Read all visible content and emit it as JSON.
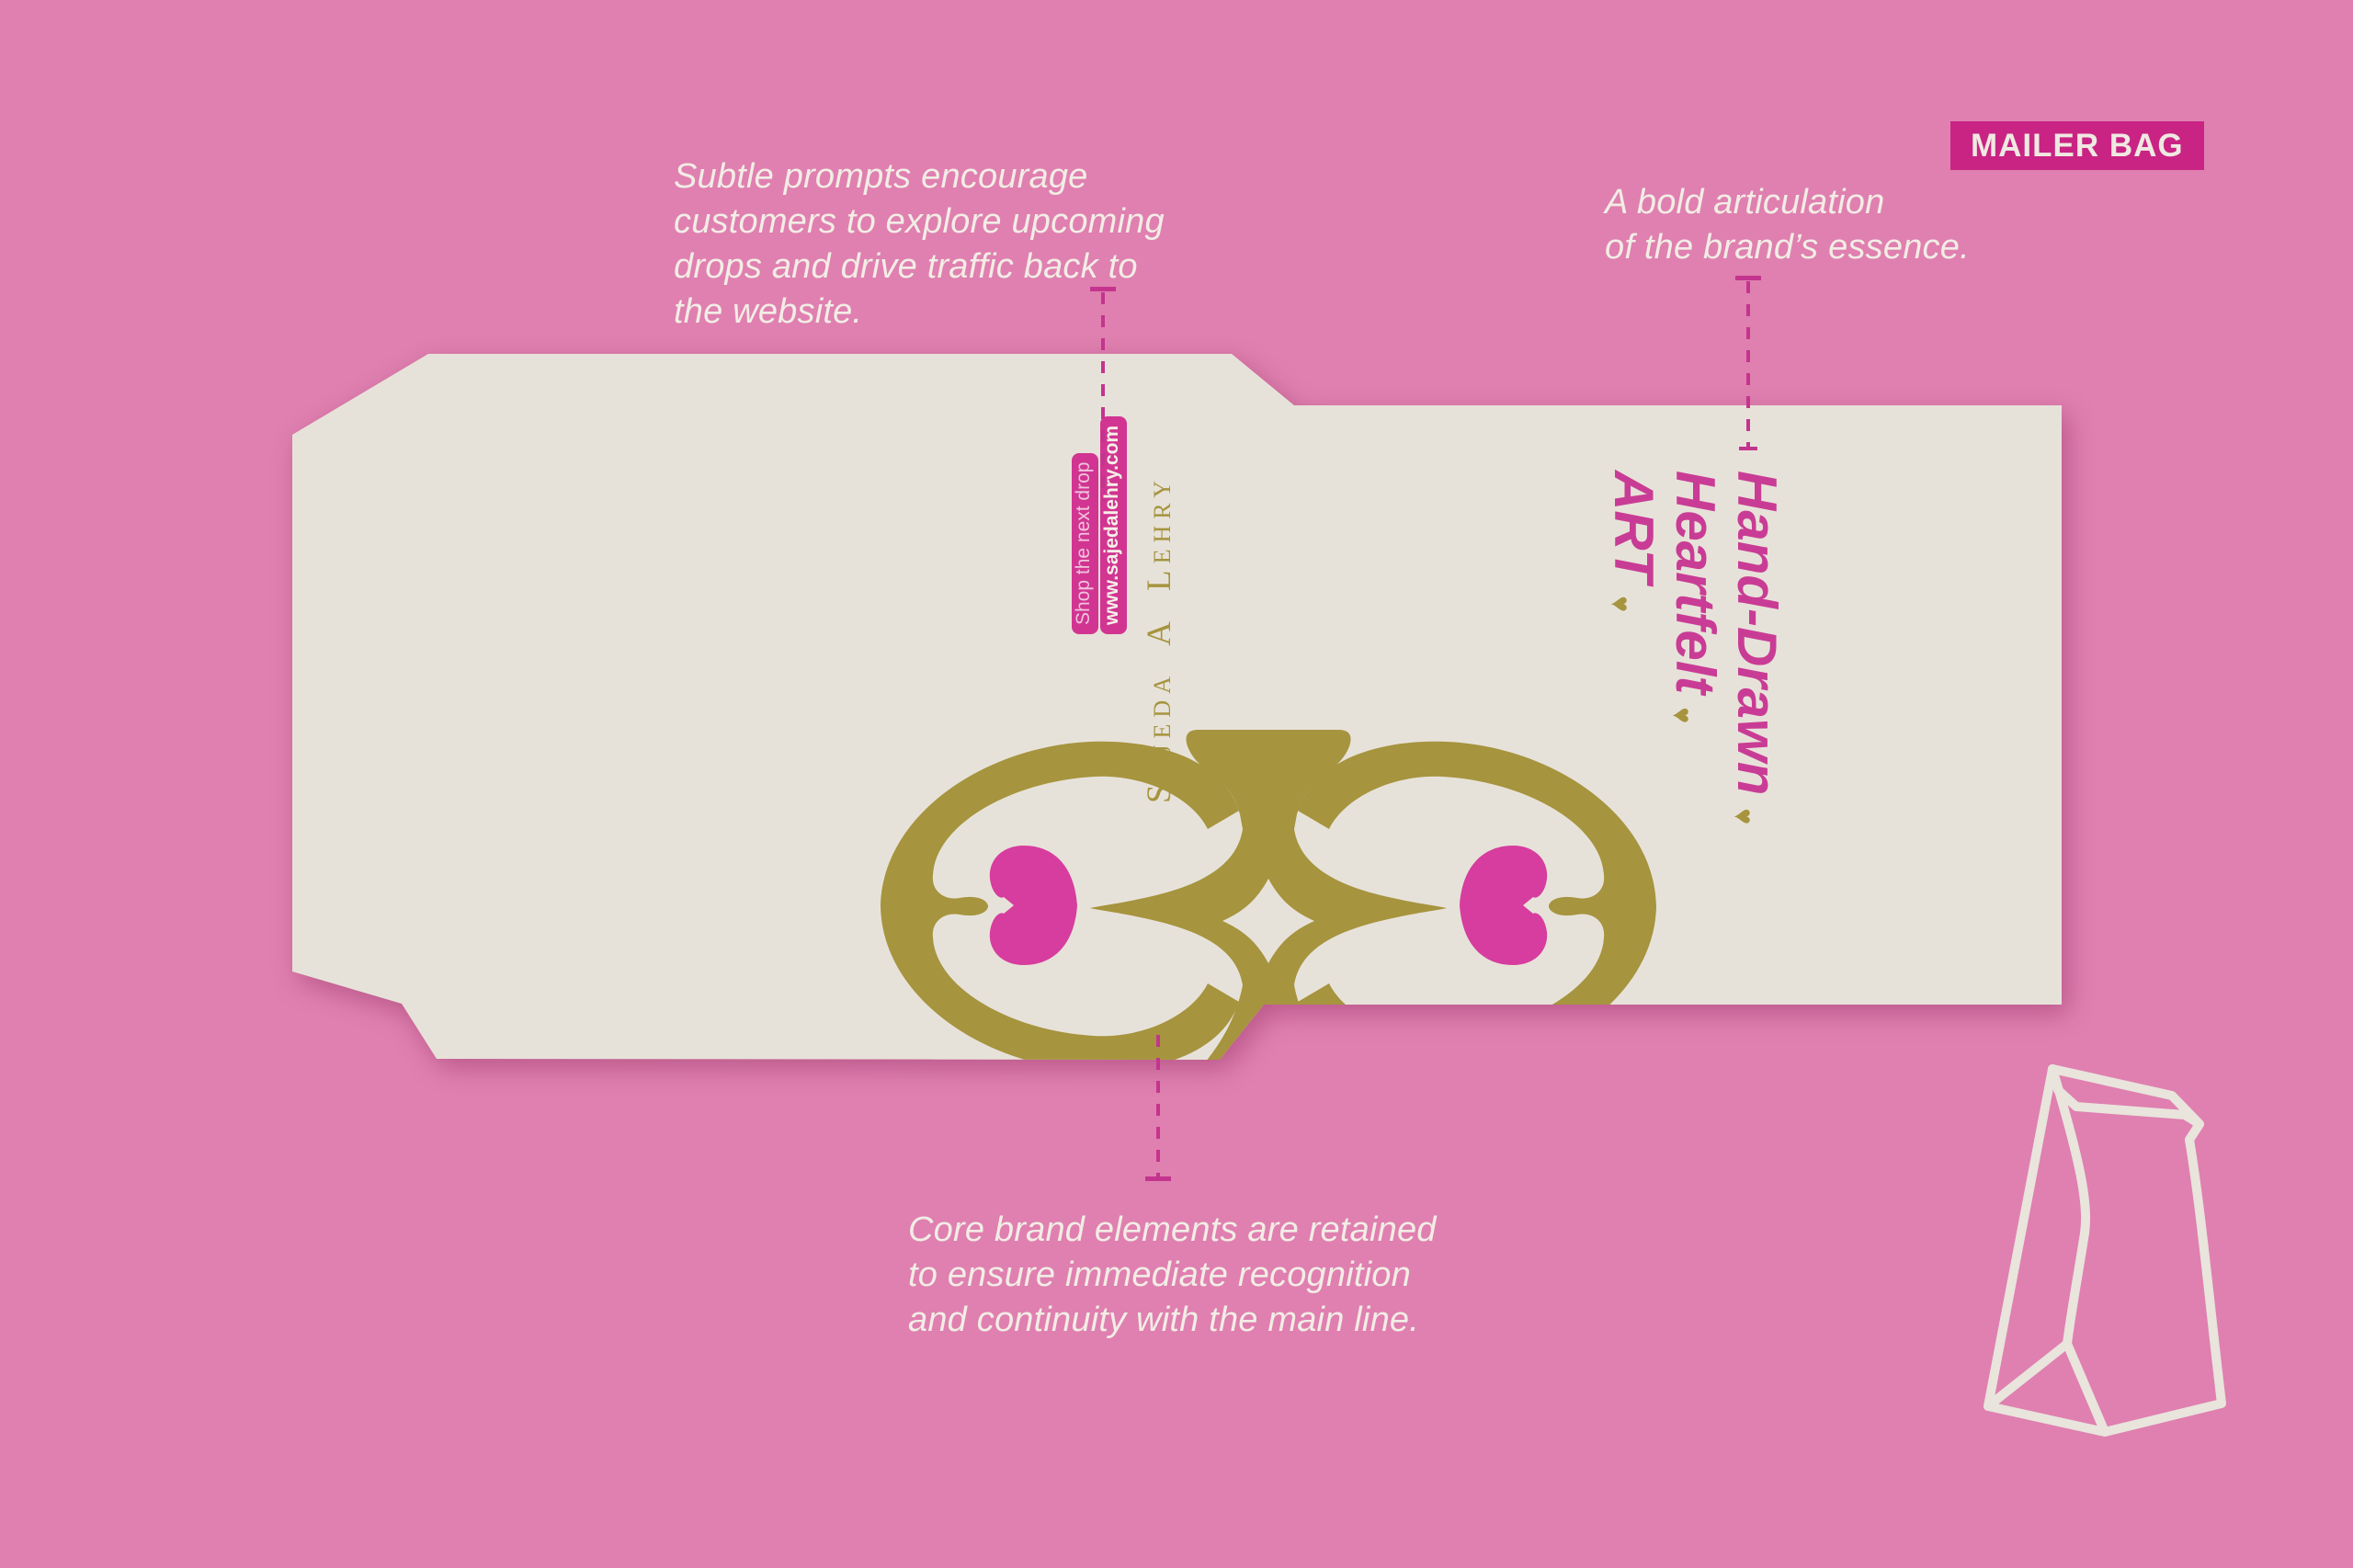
{
  "header": {
    "badge_label": "MAILER BAG"
  },
  "annotations": {
    "top_left": {
      "lines": [
        "Subtle prompts encourage",
        "customers to explore upcoming",
        "drops and drive traffic back to",
        "the website."
      ]
    },
    "right": {
      "lines": [
        "A bold articulation",
        "of the brand’s essence."
      ]
    },
    "bottom": {
      "lines": [
        "Core brand elements are retained",
        "to ensure immediate recognition",
        "and continuity with the main line."
      ]
    }
  },
  "bag": {
    "brand_name": "Sajeda A Lehry",
    "tag": {
      "line1": "Shop the next drop",
      "line2": "www.sajedalehry.com"
    },
    "slogan": {
      "words": [
        "Hand-Drawn",
        "Heartfelt",
        "ART"
      ],
      "heart_symbol": "♥"
    }
  },
  "colors": {
    "background": "#DF80B0",
    "bag_cream": "#E7E2D9",
    "gold": "#A6943E",
    "badge_magenta": "#C92384",
    "tag_magenta": "#D13591",
    "heart_pink": "#D63D9E",
    "dash_magenta": "#C4348E",
    "note_text": "#F2EDE5"
  },
  "icons": {
    "paper_bag": "paper-bag-outline",
    "ornament": "heart-scroll-ornament",
    "heart": "♥"
  }
}
